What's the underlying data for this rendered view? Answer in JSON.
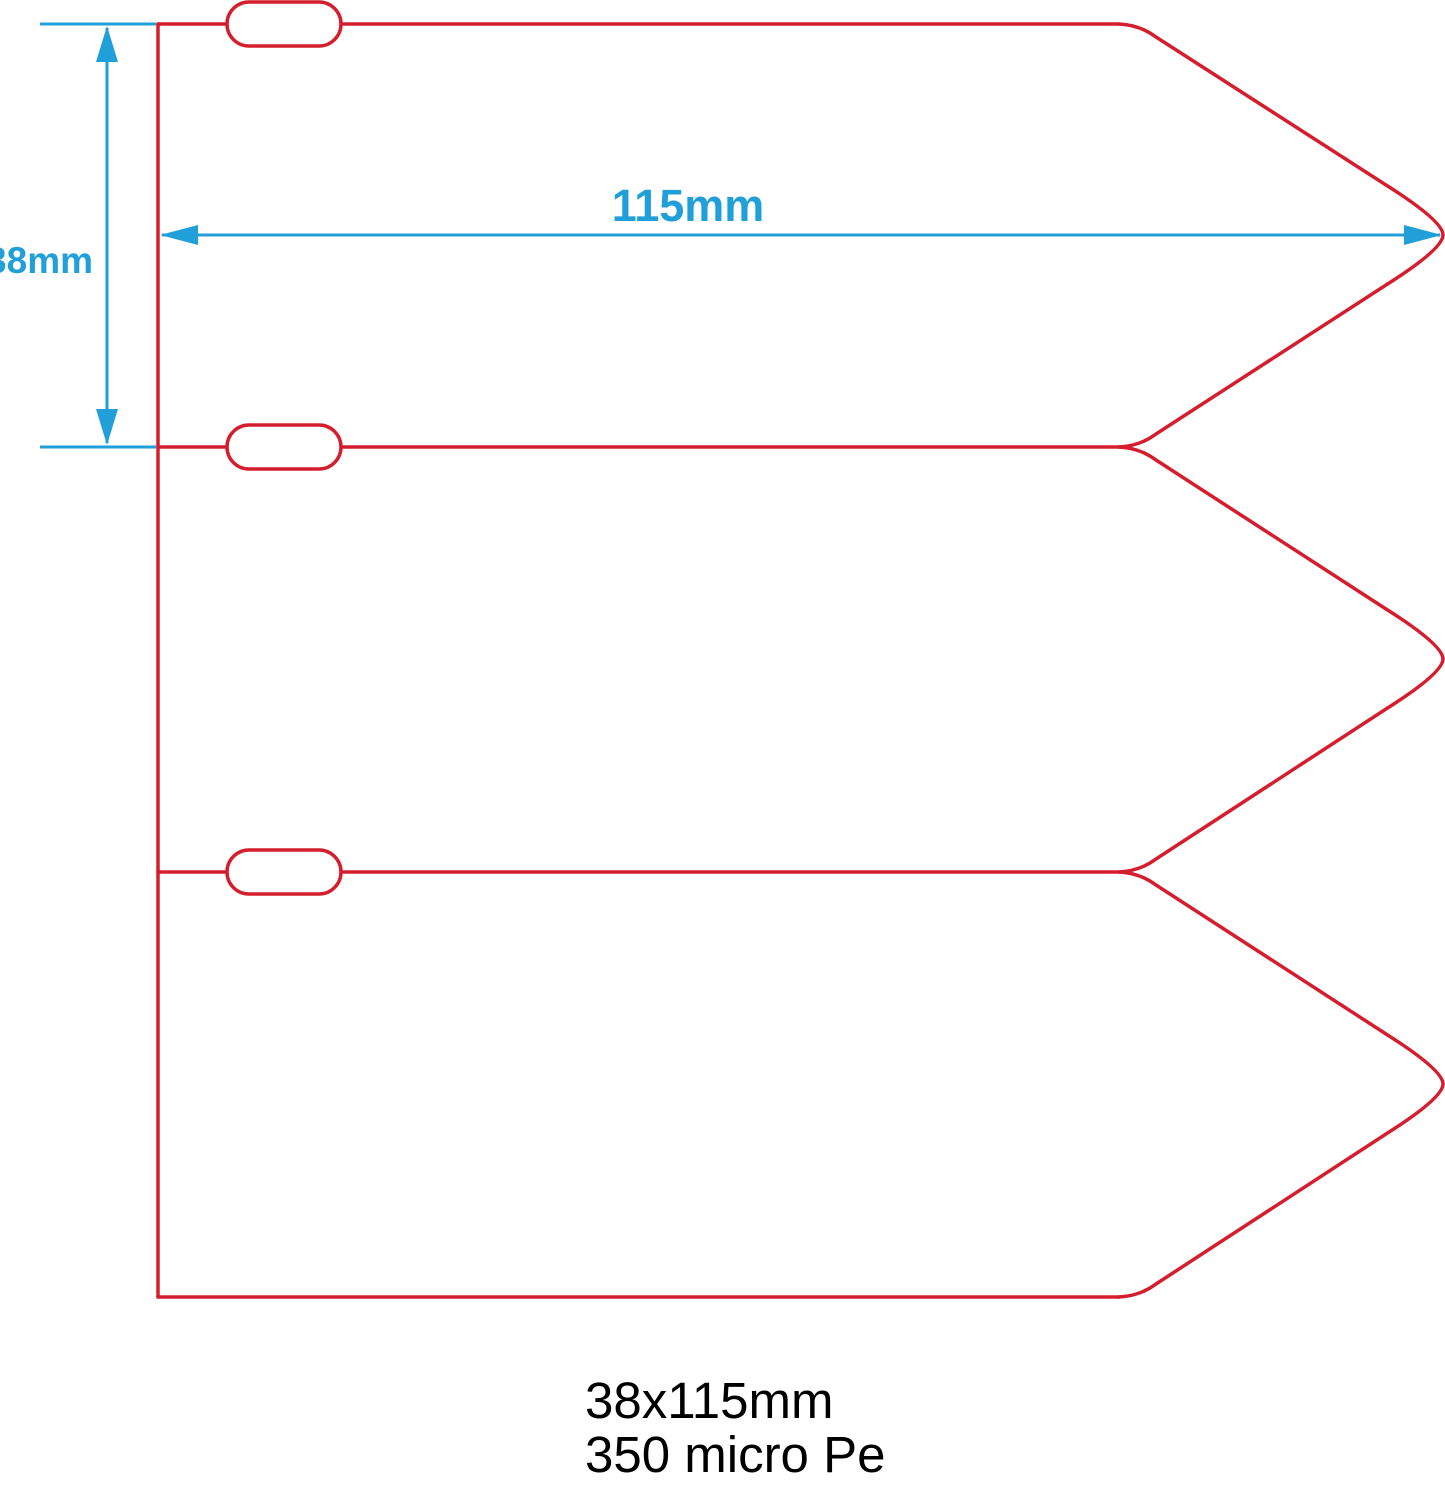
{
  "colors": {
    "outline_red": "#d51e2d",
    "dimension_blue": "#219fd9",
    "caption_black": "#000000",
    "background": "#ffffff"
  },
  "dimensions": {
    "width_label": "115mm",
    "height_label": "38mm"
  },
  "caption": {
    "line1": "38x115mm",
    "line2": "350 micro Pe"
  },
  "drawing": {
    "tag_count": 3
  }
}
